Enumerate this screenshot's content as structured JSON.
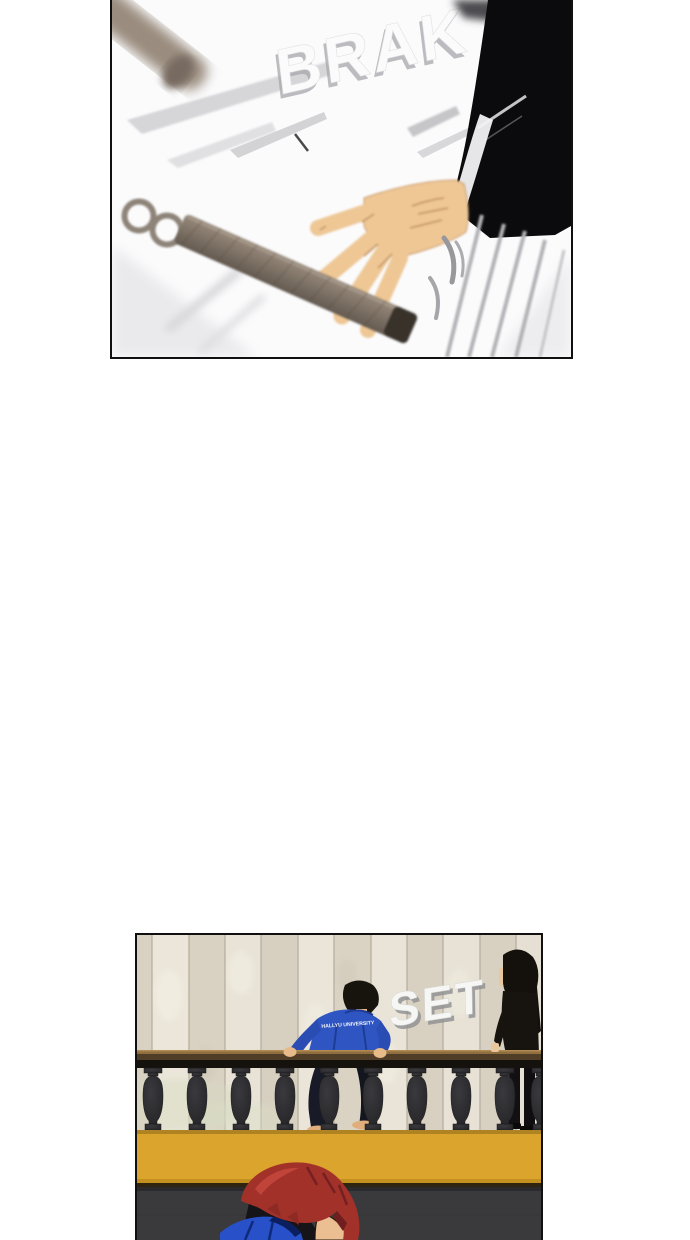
{
  "page": {
    "background": "#ffffff"
  },
  "panel_top": {
    "sfx": "BRAK",
    "scene": "nunchaku-flying-toward-hand-on-papers",
    "colors": {
      "sleeve_black": "#0b0b0d",
      "skin": "#eec795",
      "nunchaku_wood": "#8d8072",
      "paper_gray": "#d2d2d5"
    }
  },
  "panel_bottom": {
    "sfx": "SET",
    "jacket_back_text": "HALLYU UNIVERSITY",
    "scene": "man-in-blue-vaulting-balustrade-woman-in-black-watching",
    "colors": {
      "wall_beige": "#e2dccd",
      "ledge_yellow": "#dba42c",
      "jacket_blue": "#2e55c1",
      "hair_red": "#9e2f28",
      "floor_gray": "#3a3a3c"
    }
  }
}
